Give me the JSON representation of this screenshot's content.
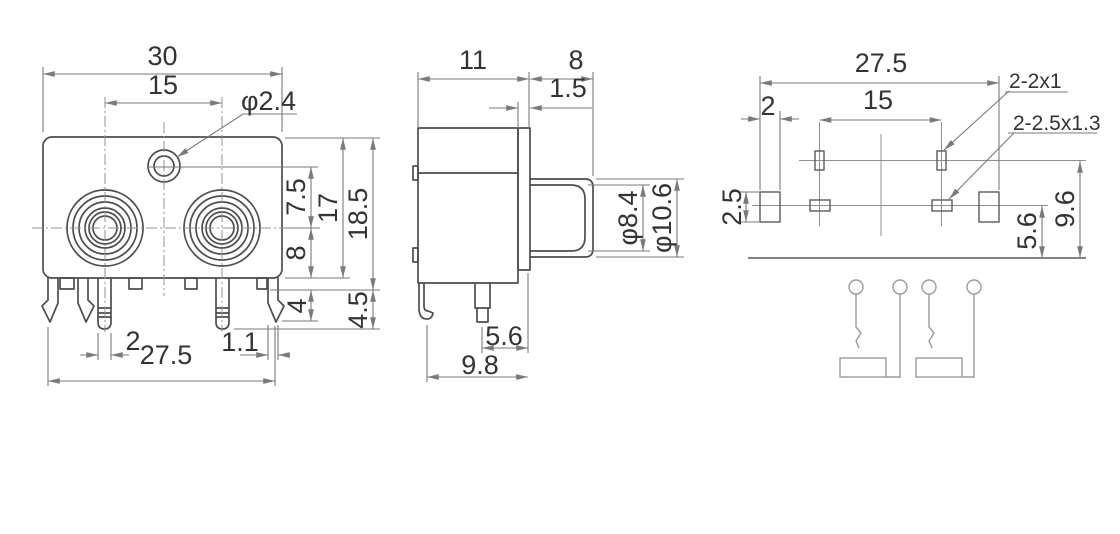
{
  "drawing_title": "RCA jack connector dimension drawing",
  "colors": {
    "background": "#ffffff",
    "object_line": "#4d4d4d",
    "dimension_line": "#7a7a7a",
    "schematic_line": "#9b9b9b",
    "text": "#333333"
  },
  "front_view": {
    "dims": {
      "body_width": "30",
      "jack_pitch": "15",
      "hole_dia": "φ2.4",
      "hole_to_center": "7.5",
      "center_to_bottom": "8",
      "body_height": "17",
      "overall_height": "18.5",
      "leg_length": "4",
      "leg_overall": "4.5",
      "pin_width": "2",
      "tab_thickness": "1.1",
      "leg_span": "27.5"
    }
  },
  "side_view": {
    "dims": {
      "body_depth": "11",
      "barrel_length": "8",
      "panel_step": "1.5",
      "barrel_inner_dia": "φ8.4",
      "barrel_outer_dia": "φ10.6",
      "pin_to_front": "5.6",
      "overall_depth": "9.8"
    }
  },
  "pcb_view": {
    "dims": {
      "hole_span": "27.5",
      "edge_offset": "2",
      "pad_pitch": "15",
      "slot_small_label": "2-2x1",
      "slot_large_label": "2-2.5x1.3",
      "anchor_height": "2.5",
      "row_offset": "5.6",
      "edge_to_row": "9.6"
    }
  }
}
